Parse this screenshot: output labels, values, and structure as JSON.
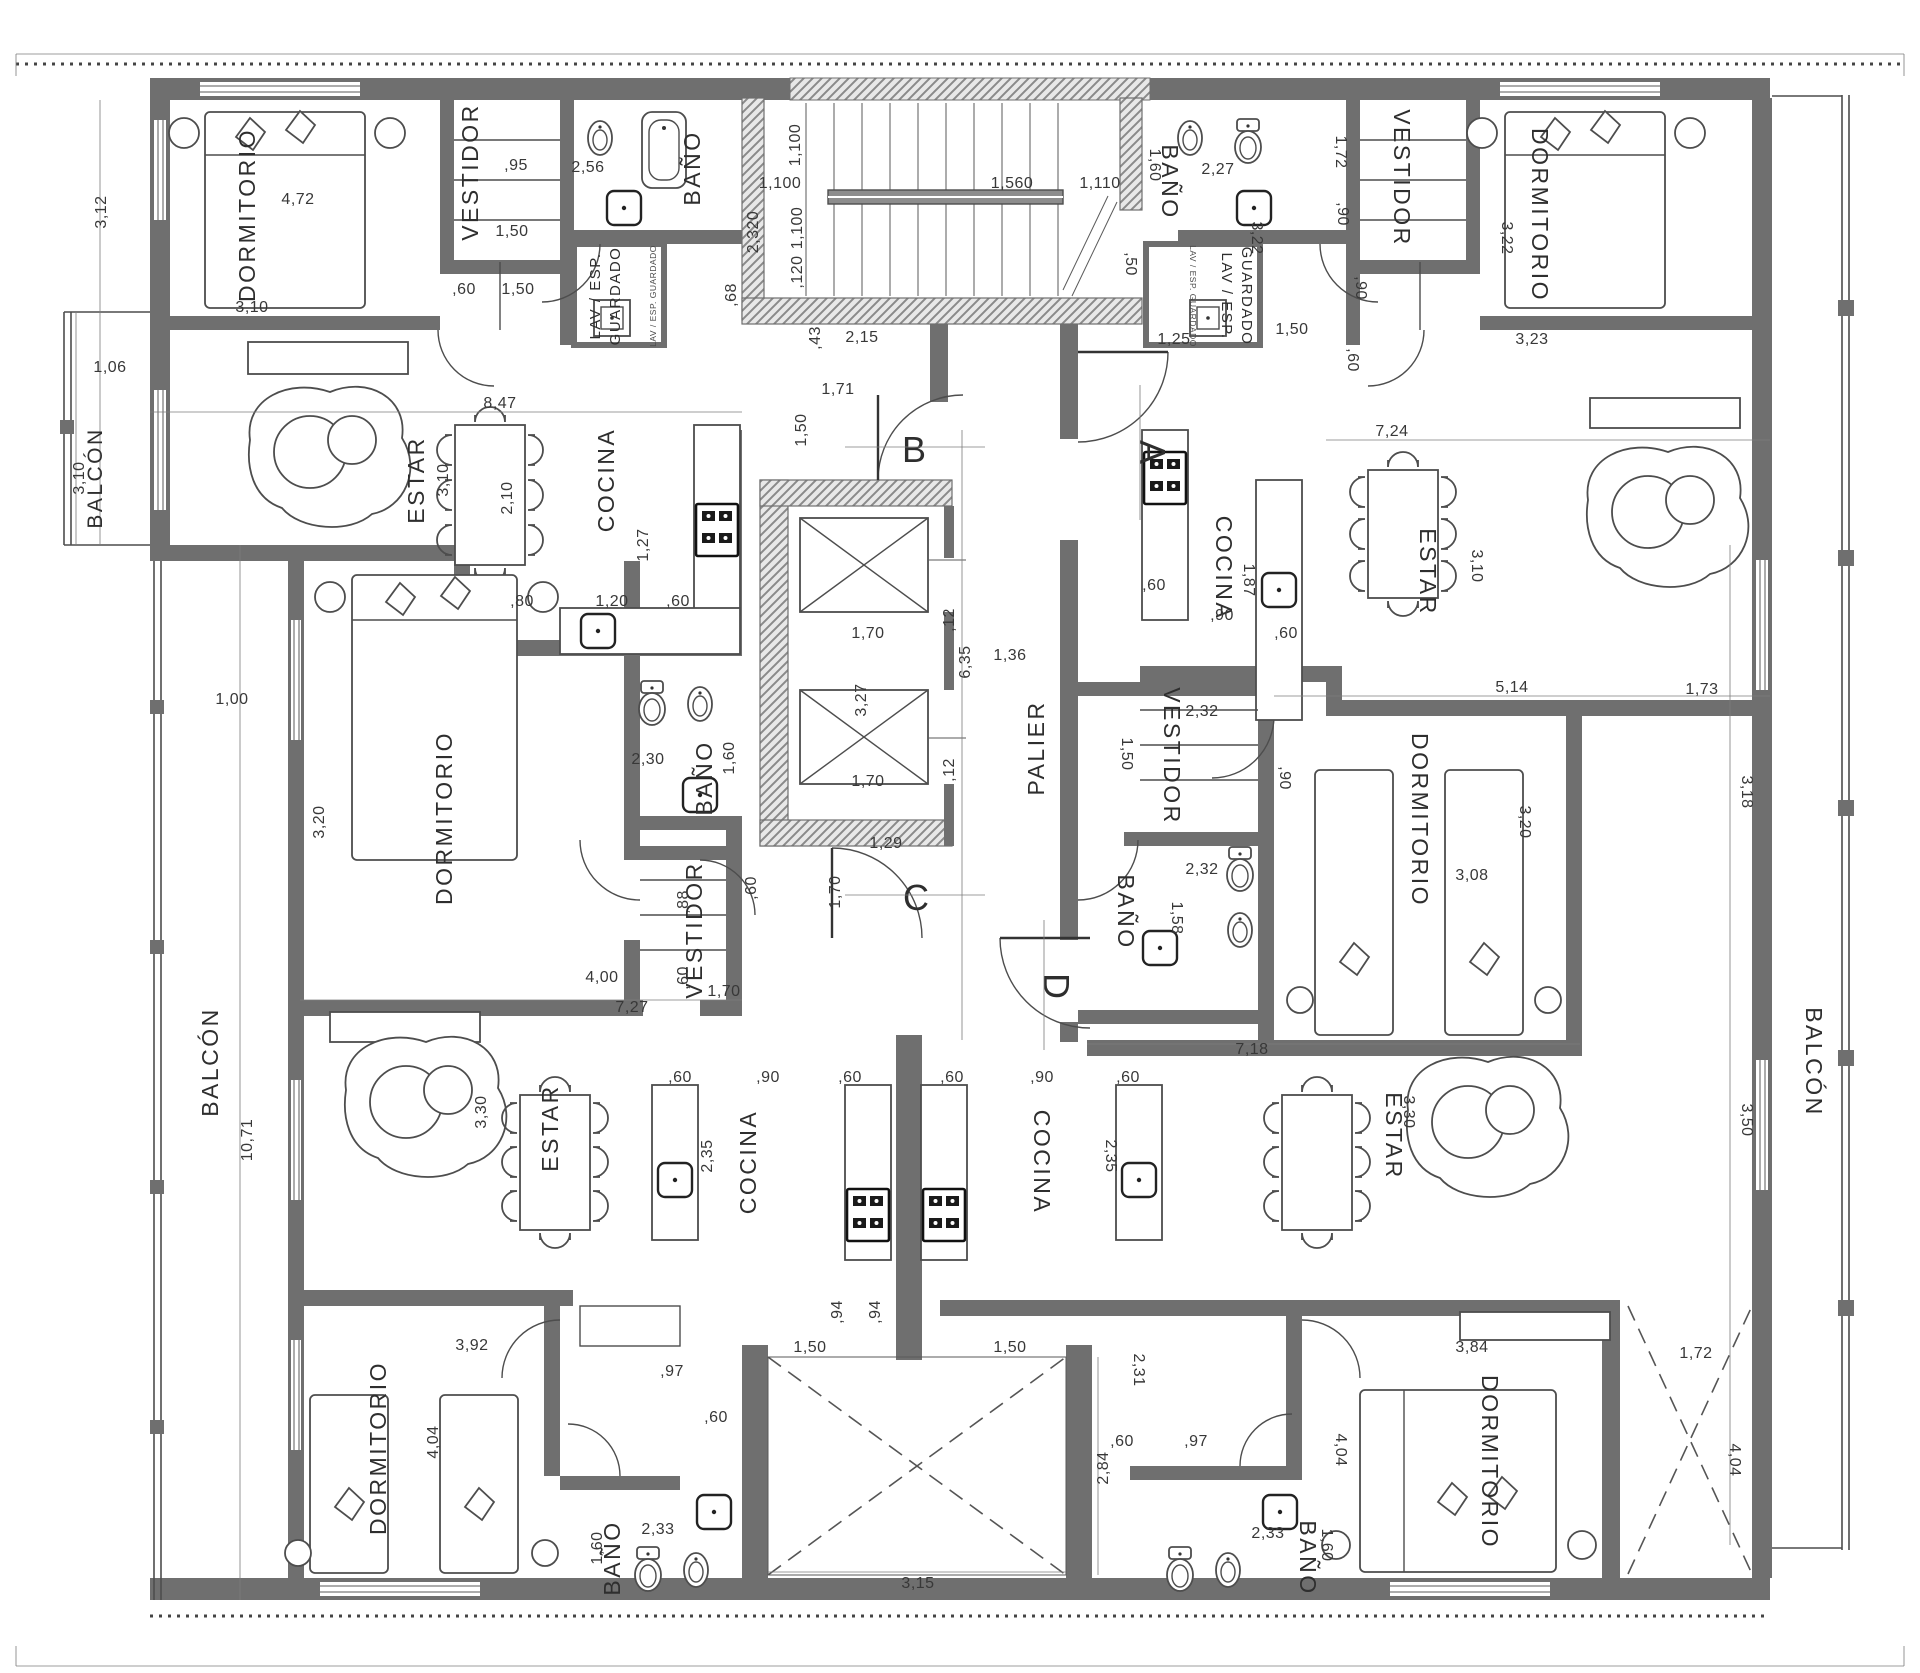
{
  "drawing": {
    "kind": "residential floor plan",
    "units": {
      "a": "A",
      "b": "B",
      "c": "C",
      "d": "D"
    },
    "rooms": {
      "dormitorio": "DORMITORIO",
      "vestidor": "VESTIDOR",
      "bano": "BAÑO",
      "estar": "ESTAR",
      "cocina": "COCINA",
      "balcon": "BALCÓN",
      "palier": "PALIER"
    },
    "closet": {
      "line1": "LAV / ESP.",
      "line2": "GUARDADO",
      "small": "LAV / ESP. GUARDADO"
    },
    "dims": {
      "d312": "3,12",
      "d472": "4,72",
      "d310": "3,10",
      "d106": "1,06",
      "d095": ",95",
      "d150": "1,50",
      "d060": ",60",
      "d256": "2,56",
      "d068": ",68",
      "d847": "8,47",
      "d210": "2,10",
      "d127": "1,27",
      "d080": ",80",
      "d120": "1,20",
      "d1100": "1,100",
      "d2320": "2,320",
      "d0120": ",120",
      "d1560": "1,560",
      "d1110": "1,110",
      "d043": ",43",
      "d215": "2,15",
      "d171": "1,71",
      "d160": "1,60",
      "d227": "2,27",
      "d050": ",50",
      "d125": "1,25",
      "d172": "1,72",
      "d090": ",90",
      "d322": "3,22",
      "d323": "3,23",
      "d724": "7,24",
      "d187": "1,87",
      "d514": "5,14",
      "d170": "1,70",
      "d327": "3,27",
      "d012": ",12",
      "d635": "6,35",
      "d136": "1,36",
      "d129": "1,29",
      "d100": "1,00",
      "d320": "3,20",
      "d400": "4,00",
      "d230": "2,30",
      "d088": ",88",
      "d727": "7,27",
      "d330": "3,30",
      "d235": "2,35",
      "d392": "3,92",
      "d404": "4,04",
      "d233": "2,33",
      "d097": ",97",
      "d094": ",94",
      "d315": "3,15",
      "d284": "2,84",
      "d231": "2,31",
      "d384": "3,84",
      "d718": "7,18",
      "d308": "3,08",
      "d158": "1,58",
      "d232": "2,32",
      "d1071": "10,71",
      "d173": "1,73",
      "d318": "3,18",
      "d350": "3,50"
    },
    "colors": {
      "wall": "#6f6f6f",
      "line": "#4d4d4d",
      "background": "#ffffff"
    }
  }
}
